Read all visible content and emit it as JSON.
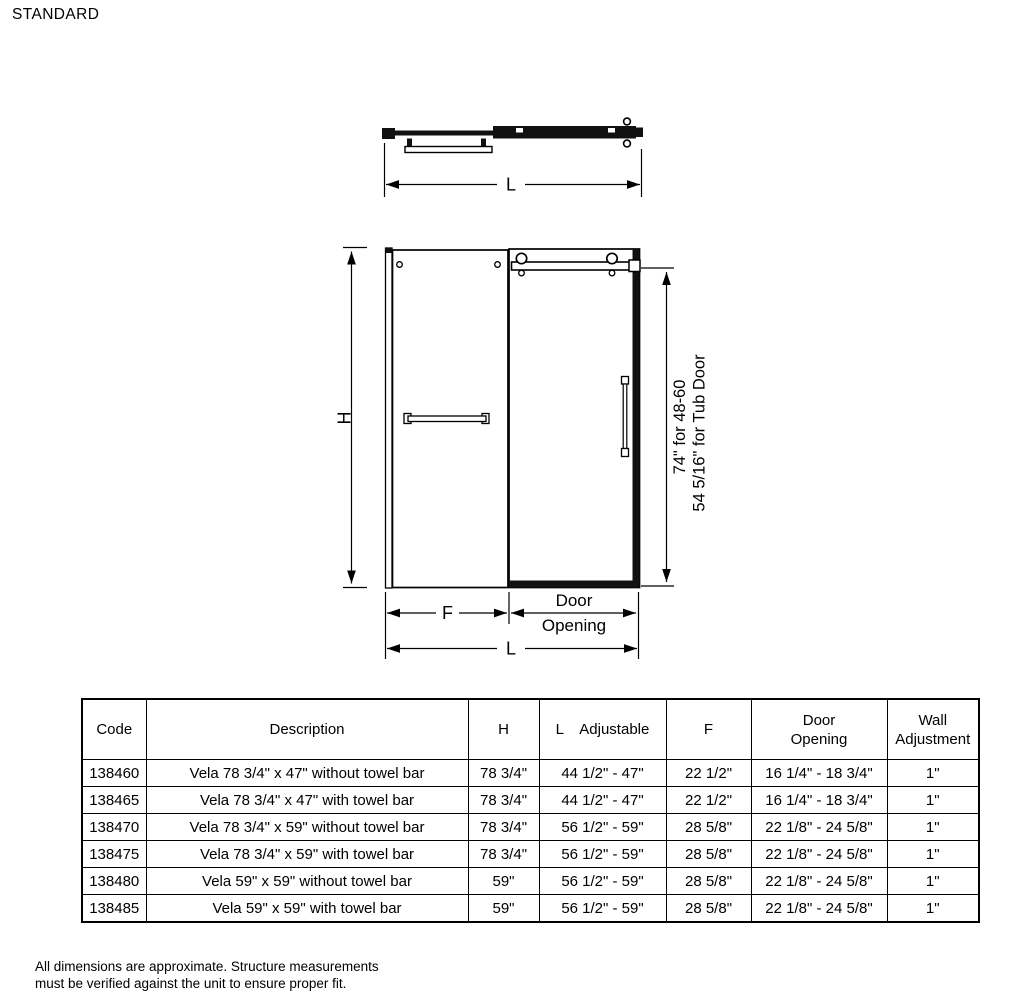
{
  "title": "STANDARD",
  "diagram": {
    "plan_view": {
      "length_label": "L"
    },
    "front_view": {
      "height_label": "H",
      "fixed_width_label": "F",
      "door_opening_line1": "Door",
      "door_opening_line2": "Opening",
      "length_label": "L",
      "door_height_line1": "74\" for 48-60",
      "door_height_line2": "54 5/16\" for Tub Door"
    }
  },
  "table": {
    "headers": {
      "code": "Code",
      "description": "Description",
      "h": "H",
      "l_adjustable": "L    Adjustable",
      "f": "F",
      "door_opening": "Door\nOpening",
      "wall_adjustment": "Wall\nAdjustment"
    },
    "rows": [
      [
        "138460",
        "Vela 78 3/4\" x 47\" without towel bar",
        "78 3/4\"",
        "44 1/2\" - 47\"",
        "22 1/2\"",
        "16 1/4\" - 18 3/4\"",
        "1\""
      ],
      [
        "138465",
        "Vela 78 3/4\" x 47\" with towel bar",
        "78 3/4\"",
        "44 1/2\" - 47\"",
        "22 1/2\"",
        "16 1/4\" - 18 3/4\"",
        "1\""
      ],
      [
        "138470",
        "Vela 78 3/4\" x 59\" without towel bar",
        "78 3/4\"",
        "56 1/2\" - 59\"",
        "28 5/8\"",
        "22 1/8\" - 24 5/8\"",
        "1\""
      ],
      [
        "138475",
        "Vela 78 3/4\" x 59\" with towel bar",
        "78 3/4\"",
        "56 1/2\" - 59\"",
        "28 5/8\"",
        "22 1/8\" - 24 5/8\"",
        "1\""
      ],
      [
        "138480",
        "Vela 59\" x 59\" without towel bar",
        "59\"",
        "56 1/2\" - 59\"",
        "28 5/8\"",
        "22 1/8\" - 24 5/8\"",
        "1\""
      ],
      [
        "138485",
        "Vela 59\" x 59\" with towel bar",
        "59\"",
        "56 1/2\" - 59\"",
        "28 5/8\"",
        "22 1/8\" - 24 5/8\"",
        "1\""
      ]
    ]
  },
  "footnote": {
    "line1": "All dimensions are approximate. Structure measurements",
    "line2": "must be verified against the unit to ensure proper fit."
  }
}
